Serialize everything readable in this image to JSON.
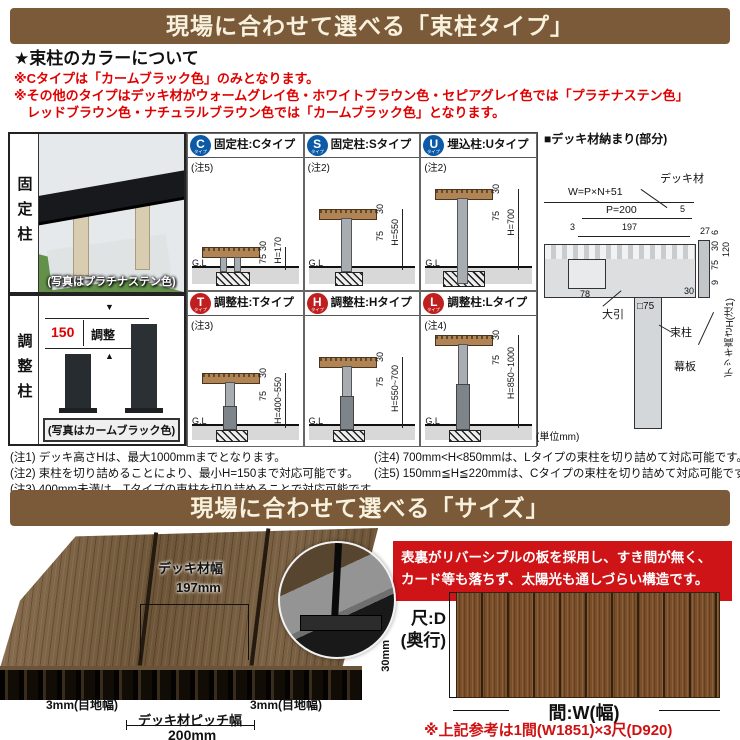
{
  "s1": {
    "header": "現場に合わせて選べる「束柱タイプ」",
    "color_title": "★束柱のカラーについて",
    "color_notes": [
      "※Cタイプは「カームブラック色」のみとなります。",
      "※その他のタイプはデッキ材がウォームグレイ色・ホワイトブラウン色・セピアグレイ色では「プラチナステン色」",
      "　レッドブラウン色・ナチュラルブラウン色では「カームブラック色」となります。"
    ],
    "left": {
      "fixed_label": "固定柱",
      "fixed_caption": "(写真はプラチナステン色)",
      "adjust_label": "調整柱",
      "adjust_caption": "(写真はカームブラック色)",
      "adjust_dim": "150",
      "adjust_word": "調整"
    },
    "gl": "G.L",
    "unit": "(単位mm)",
    "types": [
      {
        "letter": "C",
        "word": "タイプ",
        "title": "固定柱:Cタイプ",
        "note": "(注5)",
        "d30": "30",
        "d75": "75",
        "h": "H=170"
      },
      {
        "letter": "S",
        "word": "タイプ",
        "title": "固定柱:Sタイプ",
        "note": "(注2)",
        "d30": "30",
        "d75": "75",
        "h": "H=550"
      },
      {
        "letter": "U",
        "word": "タイプ",
        "title": "埋込柱:Uタイプ",
        "note": "(注2)",
        "d30": "30",
        "d75": "75",
        "h": "H=700"
      },
      {
        "letter": "T",
        "word": "タイプ",
        "title": "調整柱:Tタイプ",
        "note": "(注3)",
        "d30": "30",
        "d75": "75",
        "h": "H=400~550"
      },
      {
        "letter": "H",
        "word": "タイプ",
        "title": "調整柱:Hタイプ",
        "note": "",
        "d30": "30",
        "d75": "75",
        "h": "H=550~700"
      },
      {
        "letter": "L",
        "word": "タイプ",
        "title": "調整柱:Lタイプ",
        "note": "(注4)",
        "d30": "30",
        "d75": "75",
        "h": "H=850~1000"
      }
    ],
    "detail": {
      "title": "■デッキ材納まり(部分)",
      "deck_label": "デッキ材",
      "w_formula": "W=P×N+51",
      "p200": "P=200",
      "d5": "5",
      "d3": "3",
      "d197": "197",
      "d27": "27",
      "d6": "6",
      "d30_top": "30",
      "d75": "75",
      "d120": "120",
      "d9": "9",
      "d78": "78",
      "obiki": "大引",
      "d30_b": "30",
      "sq75": "□75",
      "makiita": "幕板",
      "tsuka": "束柱",
      "height_label": "デッキ高さH(注1)"
    },
    "notes_left": [
      "(注1) デッキ高さHは、最大1000mmまでとなります。",
      "(注2) 束柱を切り詰めることにより、最小H=150まで対応可能です。",
      "(注3) 400mm未満は、Tタイプの束柱を切り詰めることで対応可能です。"
    ],
    "notes_right": [
      "(注4) 700mm<H<850mmは、Lタイプの束柱を切り詰めて対応可能です。",
      "(注5) 150mm≦H≦220mmは、Cタイプの束柱を切り詰めて対応可能です。"
    ]
  },
  "s2": {
    "header": "現場に合わせて選べる「サイズ」",
    "deck_width_label": "デッキ材幅",
    "deck_width": "197mm",
    "joint_left": "3mm(目地幅)",
    "joint_right": "3mm(目地幅)",
    "pitch_label": "デッキ材ピッチ幅",
    "pitch": "200mm",
    "thickness": "30mm",
    "feature_lines": [
      "表裏がリバーシブルの板を採用し、すき間が無く、",
      "カード等も落ちず、太陽光も通しづらい構造です。"
    ],
    "depth_l1": "尺:D",
    "depth_l2": "(奥行)",
    "width_label": "間:W(幅)",
    "ref_note": "※上記参考は1間(W1851)×3尺(D920)"
  }
}
